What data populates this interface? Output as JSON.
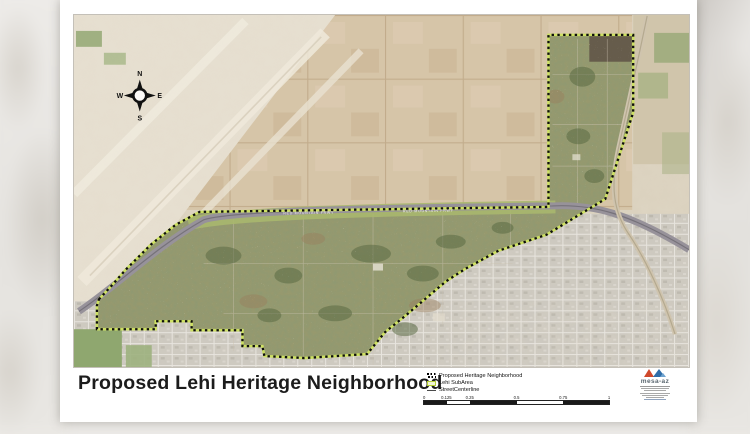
{
  "page": {
    "title": "Proposed Lehi Heritage Neighborhood"
  },
  "map": {
    "compass": {
      "north": "N",
      "east": "E",
      "south": "S",
      "west": "W"
    },
    "freeway_labels": [
      "RED MOUNTAIN FRWY",
      "RED MOUNTAIN FRWY"
    ]
  },
  "legend": {
    "items": [
      {
        "id": "proposed-heritage-neighborhood",
        "label": "Proposed Heritage Neighborhood"
      },
      {
        "id": "lehi-subarea",
        "label": "Lehi SubArea"
      },
      {
        "id": "street-centerline",
        "label": "StreetCenterline"
      }
    ]
  },
  "scale_bar": {
    "tick_labels": [
      "0",
      "0.125",
      "0.25",
      "0.5",
      "0.75",
      "1"
    ]
  },
  "logo": {
    "name": "mesa-az"
  },
  "colors": {
    "boundary_dash": "#0e0e0e",
    "subarea_line": "#cde063",
    "desert": "#dbd2bf",
    "farmland": "#d6c5a8",
    "urban": "#cdc9c0",
    "vegetation": "#97996e",
    "freeway": "#97929a",
    "logo_red": "#d0492c",
    "logo_blue": "#2f6da8"
  }
}
